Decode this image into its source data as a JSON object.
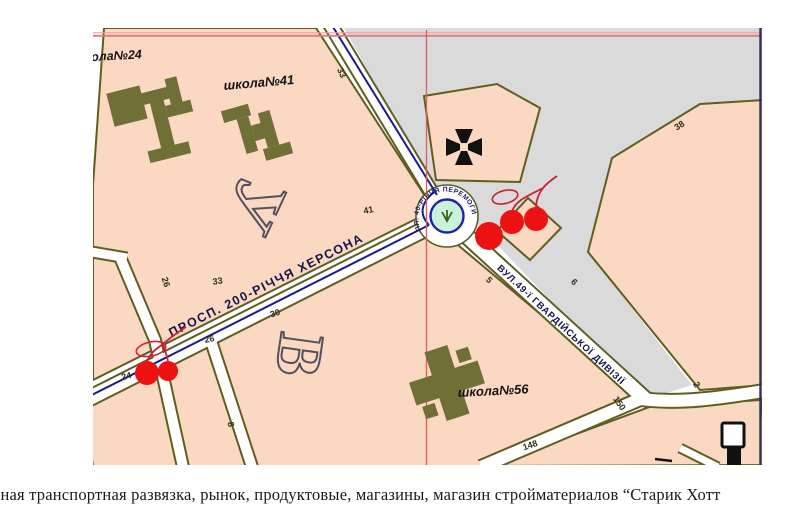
{
  "map": {
    "streets": {
      "prospekt": "ПРОСП. 200-РІЧЧЯ ХЕРСОНА",
      "hvardiiska": "ВУЛ.49-ї ГВАРДІЙСЬКОЇ ДИВІЗІЇ"
    },
    "square": "ПЛ. 40-РІЧЧЯ ПЕРЕМОГИ",
    "schools": {
      "s24": "школа№24",
      "s41": "школа№41",
      "s56": "школа№56"
    },
    "district_letters": {
      "u": "У",
      "v": "В"
    },
    "house_numbers": [
      "33",
      "33",
      "41",
      "26",
      "26",
      "24",
      "30",
      "38",
      "5",
      "6",
      "150",
      "2",
      "148",
      "8"
    ],
    "markers": {
      "church": "church-cross",
      "cherries": "hand-drawn-cherries",
      "red_dot": "red-dot",
      "poi": "black-poi"
    },
    "colors": {
      "block_pink": "#FAD8C2",
      "open_grey": "#DADADA",
      "outline_olive": "#5E5E20",
      "building_olive": "#6F7036",
      "route_navy": "#1B1B8E",
      "grid_red": "#E25B5B",
      "grid_pink": "#EF9A9A",
      "marker_red": "#EE1111",
      "island_mint": "#C9F2DA"
    }
  },
  "caption": "чная транспортная развязка, рынок, продуктовые, магазины, магазин стройматериалов “Старик Хотт"
}
